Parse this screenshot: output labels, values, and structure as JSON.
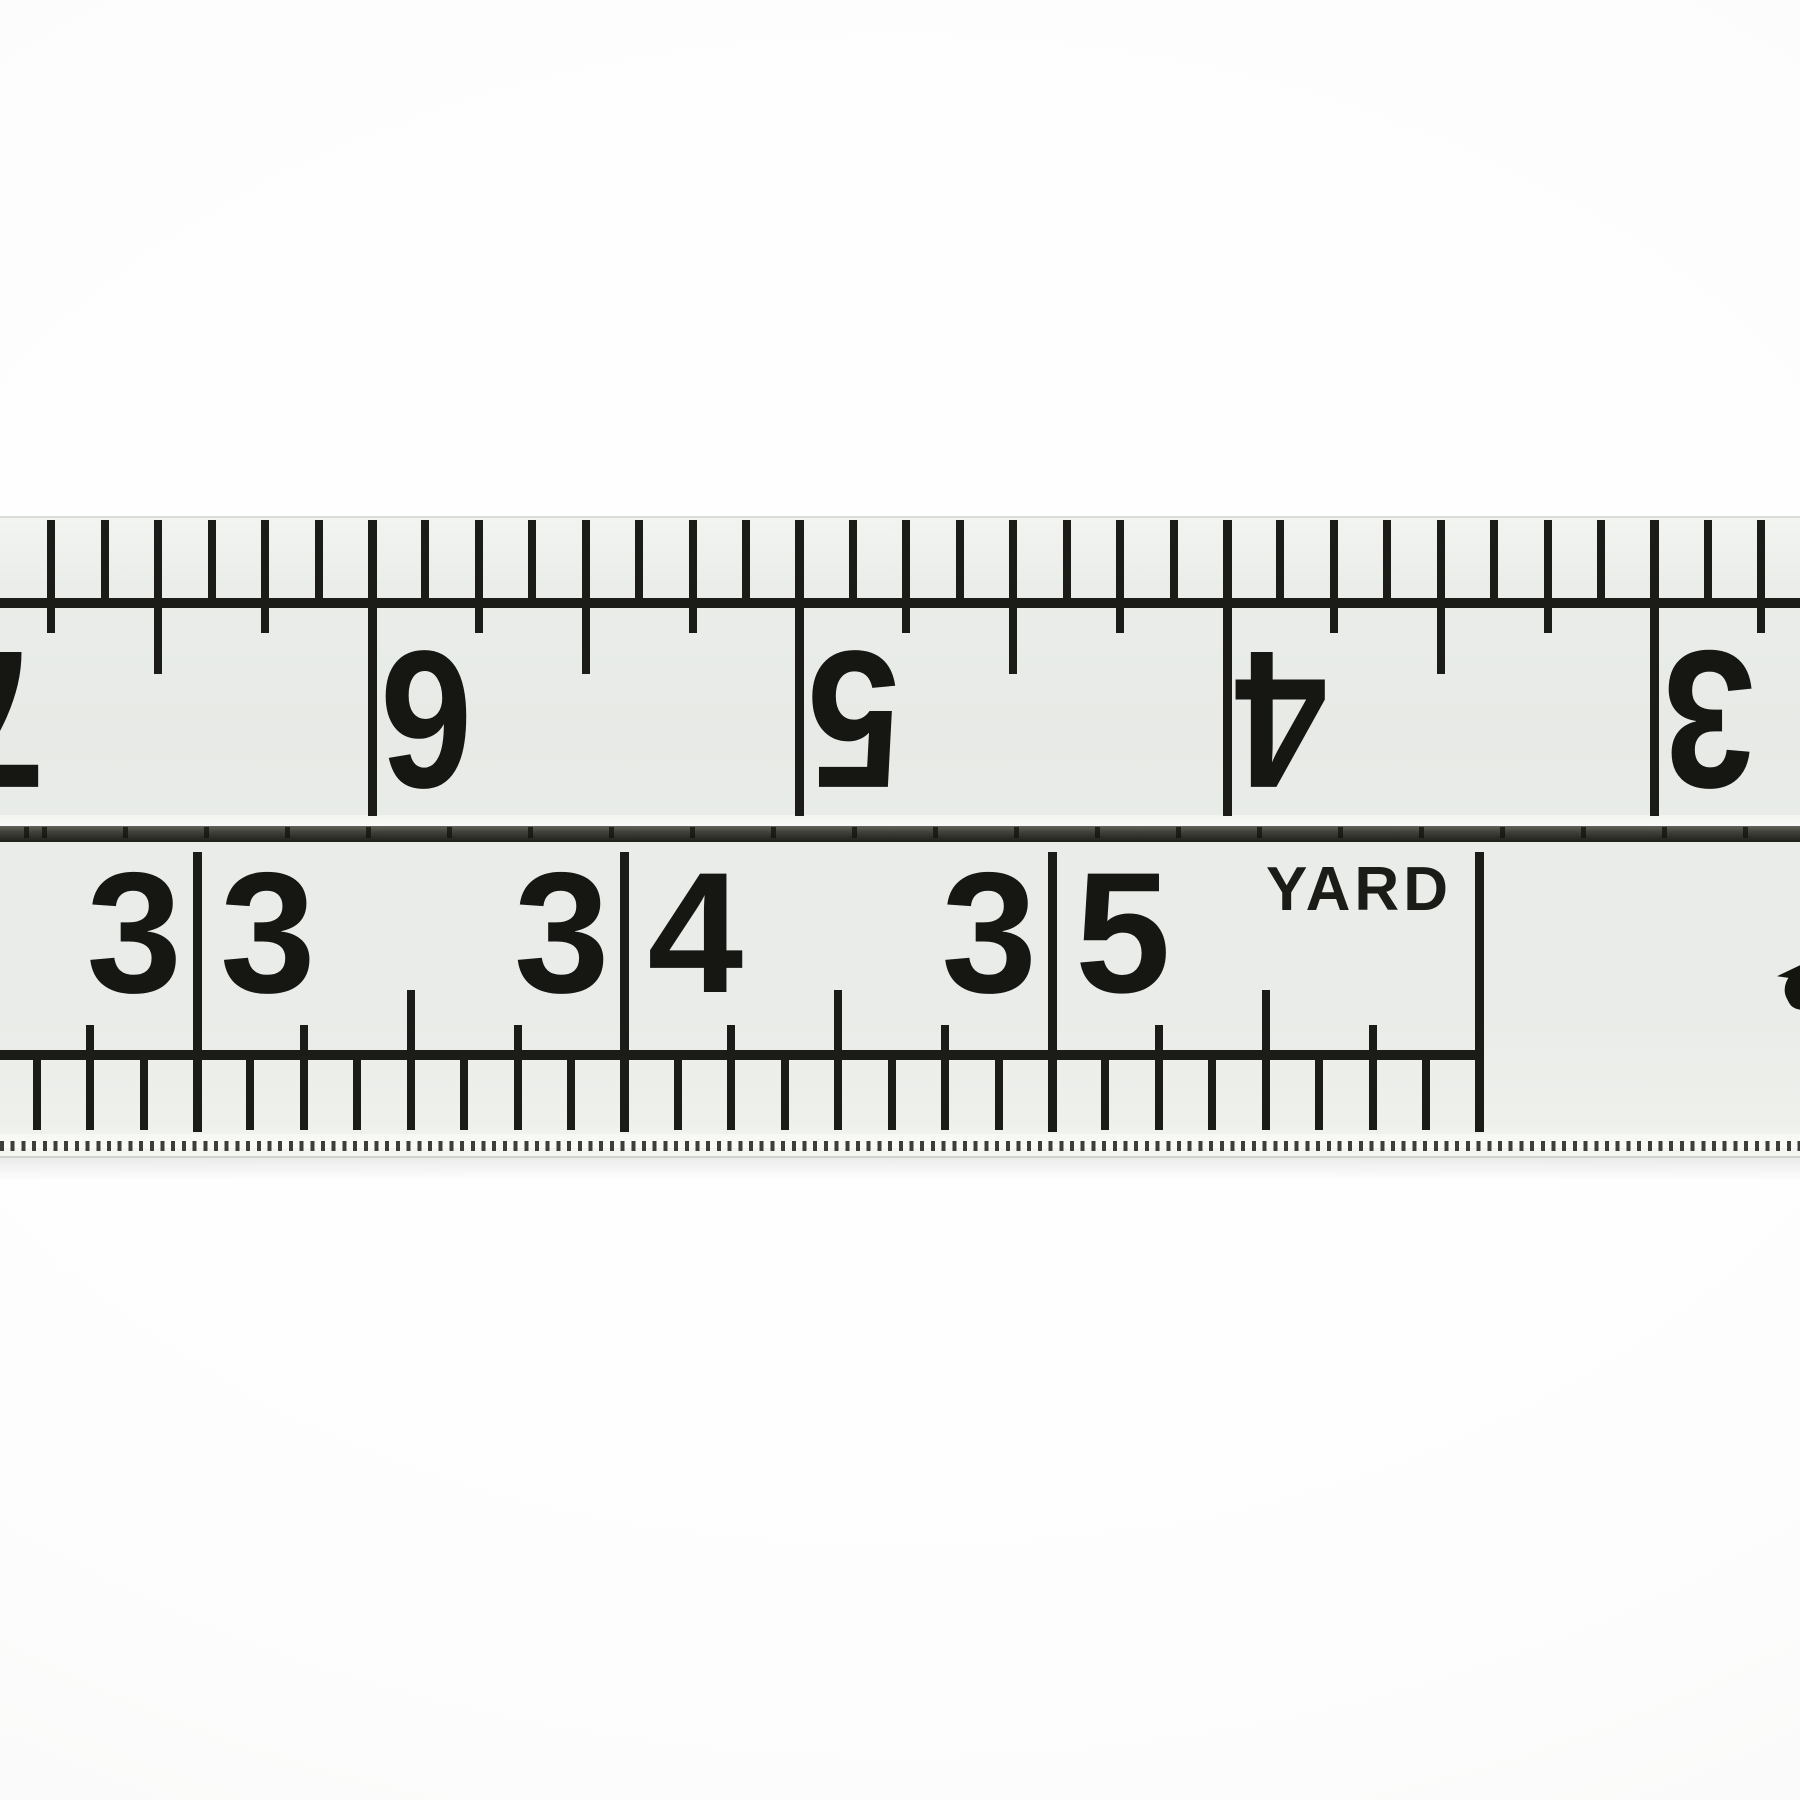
{
  "scene": {
    "description": "Close-up photograph of a white tailor's folding ruler / tape measure with black printed markings, shown against a white background. Two inch scales face each other across a dark groove.",
    "background_color": "#fdfdfd",
    "ruler_face_color": "#e9ece8",
    "ink_color": "#1b1c18",
    "separator_color": "#2b2c26"
  },
  "top_scale": {
    "unit": "inch",
    "orientation": "upside-down (rotated 180 degrees)",
    "numbers": [
      "7",
      "6",
      "5",
      "4",
      "3"
    ],
    "subdivision": "eighths of an inch",
    "note": "numbers read right-to-left because this scale runs from the opposite end of the tape"
  },
  "bottom_scale": {
    "unit": "inch",
    "numbers": [
      "33",
      "34",
      "35"
    ],
    "end_label": "YARD",
    "subdivision": "eighths of an inch",
    "note": "scale ends at the 36-inch (one yard) line; a small printed mark is clipped at the right image edge"
  }
}
